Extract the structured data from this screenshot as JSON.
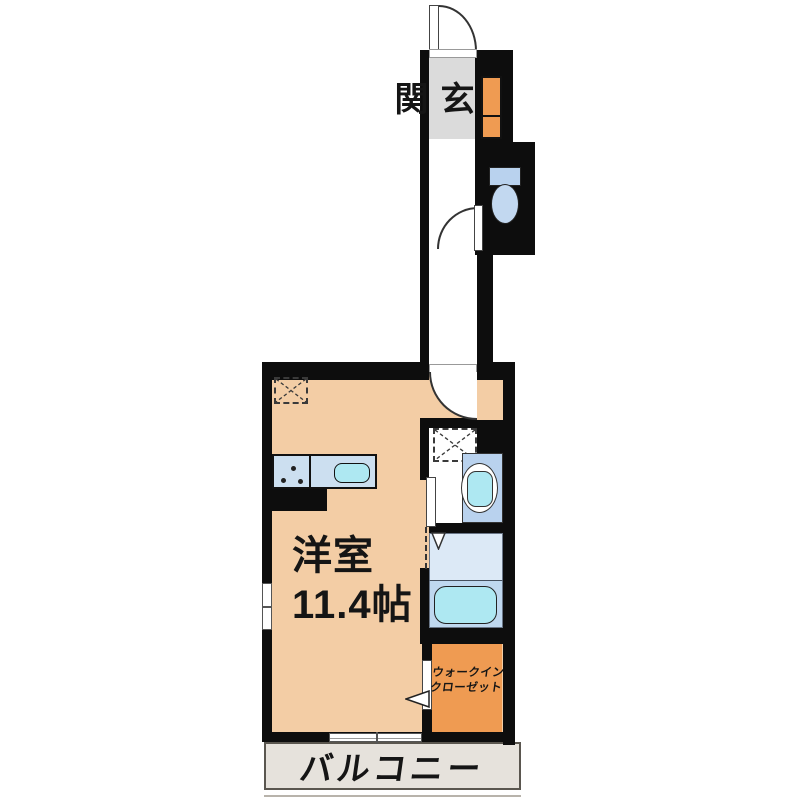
{
  "labels": {
    "entrance": "玄関",
    "room_name": "洋室",
    "room_size": "11.4帖",
    "closet_line1": "ウォークイン",
    "closet_line2": "クローゼット",
    "balcony": "バルコニー"
  },
  "colors": {
    "wall": "#0d0d0d",
    "room_floor": "#f3cda5",
    "entrance_floor": "#dbdbdb",
    "balcony_floor": "#e6e2dc",
    "closet_floor": "#ef9b52",
    "cabinet": "#ef9b52",
    "toilet_floor": "#d9e7f8",
    "bath_floor": "#dce9f6",
    "tub_zone": "#bfd8ef",
    "fixture_blue": "#b9d2ee",
    "fixture_pale": "#c2d8f0",
    "basin_cyan": "#aee8f2",
    "counter": "#ccdff0"
  }
}
